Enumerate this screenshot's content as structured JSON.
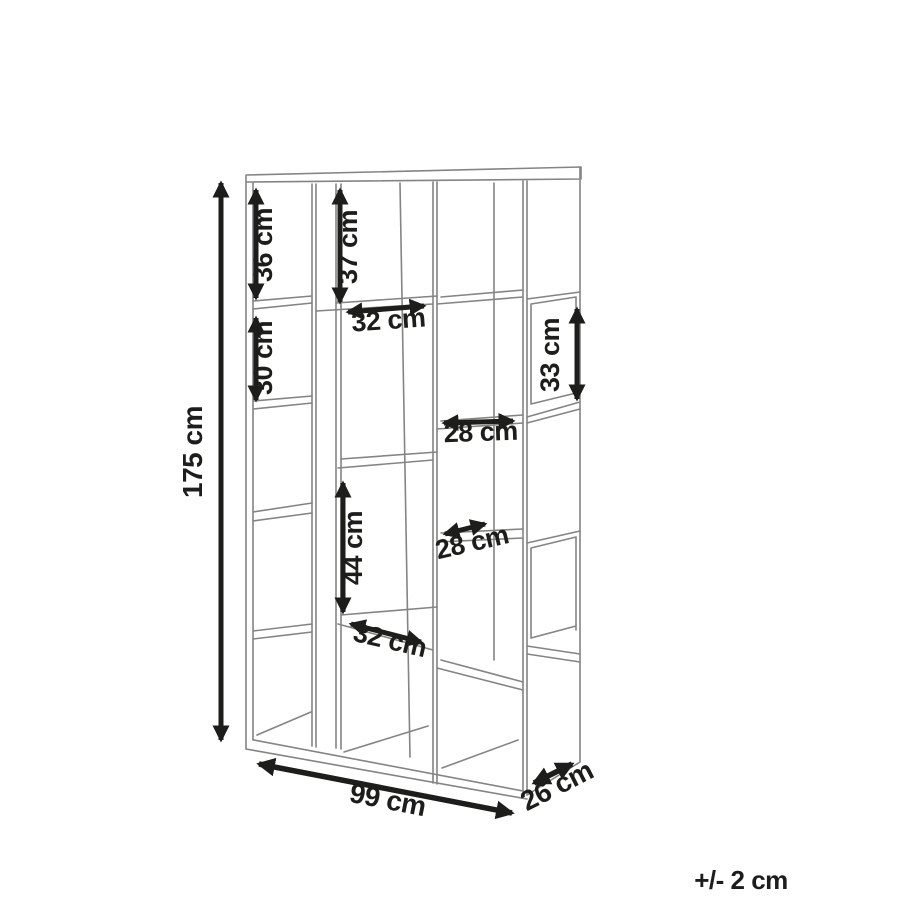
{
  "diagram": {
    "title": "bookcase-dimension-drawing",
    "unit": "cm",
    "tolerance_note": "+/- 2 cm",
    "overall": {
      "height_label": "175 cm",
      "width_label": "99 cm",
      "depth_label": "26 cm"
    },
    "compartments": {
      "left_top_height": "36 cm",
      "middle_top_height": "37 cm",
      "left_second_height": "30 cm",
      "middle_top_width": "32 cm",
      "side_cube_height": "33 cm",
      "right_upper_width": "28 cm",
      "right_middle_width": "28 cm",
      "middle_lower_height": "44 cm",
      "middle_lower_width": "32 cm"
    },
    "colors": {
      "line_gray": "#848484",
      "dimension_black": "#1d1d1b",
      "background": "#ffffff"
    }
  }
}
